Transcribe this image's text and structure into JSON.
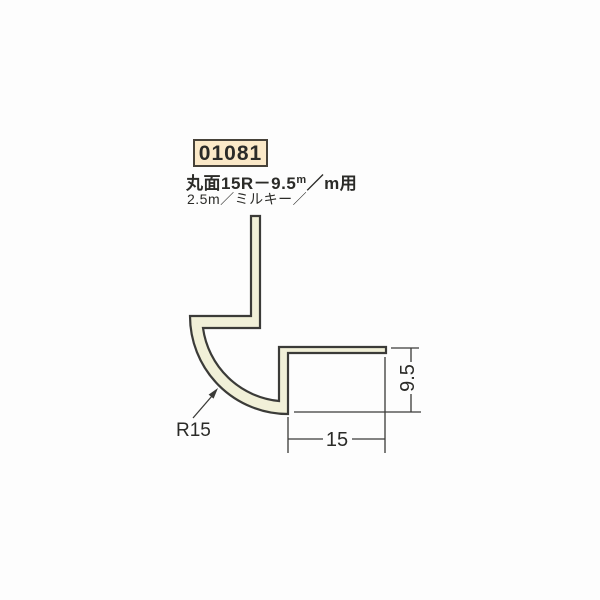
{
  "colors": {
    "page_bg": "#fdfdfd",
    "line": "#3b3b38",
    "profile_fill": "#f1f0d8",
    "code_box_bg": "#fbe9c8",
    "code_box_border": "#474239",
    "text": "#2b2b28"
  },
  "product": {
    "code": "01081",
    "title": {
      "p1": "丸面15R－9.5",
      "sup": "m",
      "p2": "／m",
      "p3": "用"
    },
    "subtitle": "2.5m／ミルキー／"
  },
  "drawing": {
    "radius_label": "R15",
    "width_label": "15",
    "height_label": "9.5"
  }
}
